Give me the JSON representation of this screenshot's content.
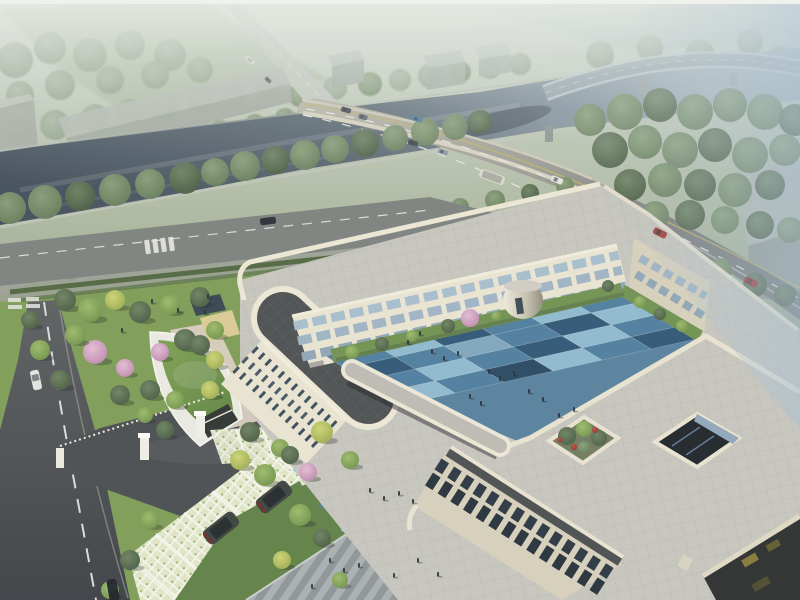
{
  "scene": {
    "type": "architectural aerial rendering",
    "description": "Hazy daytime bird's-eye view of a three-story cream-colored courtyard building complex beside a tree-lined river; a highway bridge crosses the river top-right, red cars and a bus travel the arterial road, a curved green-roof gatehouse and grass-grid parking with dark SUVs sit at the entrance, and a blue checkerboard courtyard plaza holds small groups of people."
  },
  "palette": {
    "haze_top": "#e6eae3",
    "mist_blue": "#aec1cf",
    "water": "#46525e",
    "water_far": "#9aa9b4",
    "bridge_deck": "#b7b3a4",
    "road_gray": "#74787a",
    "asphalt_dark": "#494c50",
    "local_road": "#7d817e",
    "site_lawn": "#7d9c55",
    "lawn_deep": "#5e8045",
    "facade_cream": "#e9e4d1",
    "facade_shade": "#d5cfba",
    "parapet": "#ece6d4",
    "roof_paver": "#c6c4bd",
    "roof_charcoal": "#4b4e50",
    "terrace_taupe": "#8b8074",
    "glass_band": "#a7bdcc",
    "glass_dark": "#2b3540",
    "court_base": "#57809c",
    "court_blue_light": "#8fb9cf",
    "court_blue_mid": "#4e7d9d",
    "court_blue_dark": "#2f5674",
    "court_blue_deep": "#27475f",
    "court_blue_pale": "#7fa6bd",
    "walk_blue": "#a3c2d2",
    "walk_slate": "#577e95",
    "grass_roof": "#6f9347",
    "blossom": "#d3a3c0",
    "lattice_paver": "#dfe5c4",
    "warehouse_gray": "#b2b8b1",
    "car_red": "#a23a2f",
    "suv_dark": "#3a413b",
    "plaza_stripe_light": "#a9aeb0",
    "plaza_stripe_dark": "#8e9496"
  },
  "courtyard": {
    "origin": [
      620,
      290
    ],
    "cs": [
      -49,
      11
    ],
    "rs": [
      20,
      12
    ],
    "colors": {
      "L": "#8fb9cf",
      "M": "#4e7d9d",
      "D": "#2f5674",
      "E": "#27475f",
      "G": "#7fa6bd"
    },
    "rows": [
      [
        "M",
        "L",
        "M",
        "D",
        "L",
        "M"
      ],
      [
        "L",
        "D",
        "M",
        "G",
        "M",
        "D"
      ],
      [
        "M",
        "L",
        "D",
        "M",
        "L",
        "M"
      ],
      [
        "D",
        "M",
        "L",
        "E",
        "M",
        "L"
      ]
    ]
  },
  "trees": {
    "back": [
      [
        20,
        130,
        13,
        "far"
      ],
      [
        55,
        125,
        15,
        "far"
      ],
      [
        95,
        118,
        14,
        "far"
      ],
      [
        130,
        112,
        13,
        "far"
      ],
      [
        165,
        108,
        14,
        "far"
      ],
      [
        200,
        100,
        13,
        "far"
      ],
      [
        235,
        95,
        12,
        "far"
      ],
      [
        270,
        90,
        13,
        "far"
      ],
      [
        300,
        95,
        12,
        "mid"
      ],
      [
        335,
        88,
        12,
        "far"
      ],
      [
        370,
        84,
        12,
        "mid"
      ],
      [
        400,
        80,
        11,
        "far"
      ],
      [
        430,
        76,
        12,
        "far"
      ],
      [
        460,
        72,
        11,
        "mid"
      ],
      [
        490,
        68,
        11,
        "far"
      ],
      [
        520,
        64,
        11,
        "far"
      ],
      [
        600,
        55,
        14,
        "far"
      ],
      [
        650,
        48,
        13,
        "far"
      ],
      [
        700,
        55,
        15,
        "far"
      ],
      [
        750,
        42,
        13,
        "far"
      ],
      [
        780,
        60,
        14,
        "far"
      ],
      [
        15,
        60,
        18,
        "far"
      ],
      [
        50,
        48,
        16,
        "far"
      ],
      [
        90,
        55,
        17,
        "far"
      ],
      [
        130,
        45,
        15,
        "far"
      ],
      [
        170,
        55,
        16,
        "far"
      ],
      [
        60,
        85,
        15,
        "far"
      ],
      [
        110,
        80,
        14,
        "far"
      ],
      [
        155,
        75,
        14,
        "far"
      ],
      [
        200,
        70,
        13,
        "far"
      ],
      [
        20,
        95,
        14,
        "far"
      ],
      [
        80,
        150,
        10,
        "mid"
      ],
      [
        115,
        145,
        11,
        "mid"
      ],
      [
        150,
        140,
        11,
        "mid"
      ],
      [
        185,
        135,
        10,
        "mid"
      ],
      [
        220,
        130,
        10,
        "mid"
      ],
      [
        255,
        124,
        10,
        "mid"
      ],
      [
        285,
        118,
        10,
        "mid"
      ]
    ],
    "mid": [
      [
        10,
        208,
        16,
        "mid"
      ],
      [
        45,
        202,
        17,
        "mid"
      ],
      [
        80,
        196,
        15,
        "dark"
      ],
      [
        115,
        190,
        16,
        "mid"
      ],
      [
        150,
        184,
        15,
        "mid"
      ],
      [
        185,
        178,
        16,
        "dark"
      ],
      [
        215,
        172,
        14,
        "mid"
      ],
      [
        245,
        166,
        15,
        "mid"
      ],
      [
        275,
        160,
        14,
        "dark"
      ],
      [
        305,
        155,
        15,
        "mid"
      ],
      [
        335,
        149,
        14,
        "mid"
      ],
      [
        365,
        143,
        14,
        "dark"
      ],
      [
        395,
        138,
        13,
        "mid"
      ],
      [
        425,
        132,
        14,
        "mid"
      ],
      [
        455,
        127,
        13,
        "mid"
      ],
      [
        480,
        122,
        12,
        "dark"
      ],
      [
        590,
        120,
        16,
        "mid"
      ],
      [
        625,
        112,
        18,
        "mid"
      ],
      [
        660,
        105,
        17,
        "dark"
      ],
      [
        695,
        112,
        18,
        "mid"
      ],
      [
        730,
        105,
        17,
        "mid"
      ],
      [
        765,
        112,
        18,
        "mid"
      ],
      [
        795,
        120,
        16,
        "dark"
      ],
      [
        610,
        150,
        18,
        "dark"
      ],
      [
        645,
        142,
        17,
        "mid"
      ],
      [
        680,
        150,
        18,
        "mid"
      ],
      [
        715,
        145,
        17,
        "dark"
      ],
      [
        750,
        155,
        18,
        "mid"
      ],
      [
        785,
        150,
        16,
        "mid"
      ],
      [
        630,
        185,
        16,
        "dark"
      ],
      [
        665,
        180,
        17,
        "mid"
      ],
      [
        700,
        185,
        16,
        "dark"
      ],
      [
        735,
        190,
        17,
        "mid"
      ],
      [
        770,
        185,
        15,
        "dark"
      ],
      [
        655,
        215,
        14,
        "mid"
      ],
      [
        690,
        215,
        15,
        "dark"
      ],
      [
        725,
        220,
        14,
        "mid"
      ],
      [
        760,
        225,
        14,
        "dark"
      ],
      [
        790,
        230,
        13,
        "mid"
      ],
      [
        690,
        260,
        12,
        "dark"
      ],
      [
        720,
        270,
        12,
        "mid"
      ],
      [
        755,
        285,
        12,
        "dark"
      ],
      [
        785,
        295,
        11,
        "dark"
      ],
      [
        250,
        252,
        10,
        "mid"
      ],
      [
        285,
        245,
        10,
        "dark"
      ],
      [
        320,
        237,
        10,
        "mid"
      ],
      [
        355,
        230,
        10,
        "dark"
      ],
      [
        390,
        222,
        9,
        "mid"
      ],
      [
        425,
        214,
        10,
        "dark"
      ],
      [
        460,
        207,
        9,
        "mid"
      ],
      [
        495,
        200,
        10,
        "mid"
      ],
      [
        530,
        193,
        9,
        "dark"
      ],
      [
        565,
        186,
        9,
        "mid"
      ],
      [
        30,
        280,
        9,
        "bright"
      ],
      [
        70,
        272,
        9,
        "dark"
      ],
      [
        110,
        264,
        9,
        "bright"
      ],
      [
        150,
        257,
        8,
        "dark"
      ],
      [
        190,
        250,
        9,
        "bright"
      ],
      [
        230,
        243,
        8,
        "dark"
      ],
      [
        270,
        236,
        8,
        "bright"
      ],
      [
        310,
        229,
        8,
        "dark"
      ],
      [
        350,
        222,
        8,
        "bright"
      ],
      [
        390,
        215,
        8,
        "dark"
      ],
      [
        430,
        208,
        8,
        "bright"
      ]
    ],
    "front": [
      [
        65,
        300,
        11,
        "dark",
        1
      ],
      [
        90,
        310,
        12,
        "bright",
        1
      ],
      [
        115,
        300,
        10,
        "yellow",
        1
      ],
      [
        140,
        312,
        11,
        "dark",
        1
      ],
      [
        170,
        305,
        10,
        "bright",
        1
      ],
      [
        200,
        297,
        10,
        "dark",
        1
      ],
      [
        95,
        352,
        12,
        "pink",
        1
      ],
      [
        125,
        368,
        9,
        "pink",
        1
      ],
      [
        160,
        352,
        9,
        "pink",
        1
      ],
      [
        75,
        335,
        10,
        "bright",
        1
      ],
      [
        185,
        340,
        11,
        "dark",
        1
      ],
      [
        215,
        330,
        9,
        "bright",
        1
      ],
      [
        200,
        345,
        10,
        "dark",
        1
      ],
      [
        215,
        360,
        9,
        "yellow",
        1
      ],
      [
        150,
        390,
        10,
        "dark",
        1
      ],
      [
        175,
        400,
        9,
        "bright",
        1
      ],
      [
        120,
        395,
        10,
        "dark",
        1
      ],
      [
        210,
        390,
        9,
        "yellow",
        1
      ],
      [
        60,
        380,
        10,
        "dark",
        1
      ],
      [
        40,
        350,
        10,
        "bright",
        1
      ],
      [
        30,
        320,
        9,
        "dark",
        1
      ],
      [
        165,
        430,
        9,
        "dark",
        1
      ],
      [
        145,
        415,
        8,
        "bright",
        1
      ],
      [
        250,
        432,
        10,
        "dark",
        1
      ],
      [
        280,
        448,
        9,
        "bright",
        1
      ],
      [
        308,
        472,
        9,
        "pink",
        1
      ],
      [
        240,
        460,
        10,
        "yellow",
        1
      ],
      [
        265,
        475,
        11,
        "bright",
        1
      ],
      [
        290,
        455,
        9,
        "dark",
        1
      ],
      [
        300,
        515,
        11,
        "bright",
        1
      ],
      [
        322,
        538,
        9,
        "dark",
        1
      ],
      [
        282,
        560,
        9,
        "yellow",
        1
      ],
      [
        150,
        520,
        9,
        "bright",
        1
      ],
      [
        130,
        560,
        10,
        "dark",
        1
      ],
      [
        110,
        590,
        9,
        "bright",
        1
      ],
      [
        340,
        580,
        8,
        "bright",
        1
      ],
      [
        322,
        432,
        11,
        "yellow",
        1
      ],
      [
        350,
        460,
        9,
        "bright",
        1
      ],
      [
        352,
        352,
        7,
        "bright"
      ],
      [
        382,
        344,
        7,
        "dark"
      ],
      [
        412,
        336,
        6,
        "bright"
      ],
      [
        448,
        326,
        7,
        "dark"
      ],
      [
        496,
        316,
        5,
        "bright"
      ],
      [
        470,
        318,
        9,
        "pink"
      ],
      [
        640,
        302,
        6,
        "bright"
      ],
      [
        660,
        314,
        6,
        "dark"
      ],
      [
        682,
        326,
        6,
        "bright"
      ],
      [
        608,
        286,
        6,
        "dark"
      ],
      [
        567,
        436,
        9,
        "dark"
      ],
      [
        584,
        429,
        8,
        "bright"
      ],
      [
        599,
        438,
        8,
        "dark"
      ],
      [
        584,
        447,
        6,
        "mid"
      ],
      [
        574,
        447,
        3,
        "red"
      ],
      [
        595,
        430,
        3,
        "red"
      ],
      [
        560,
        440,
        2.5,
        "red"
      ]
    ]
  },
  "people": [
    [
      432,
      349
    ],
    [
      444,
      356
    ],
    [
      458,
      351
    ],
    [
      489,
      369
    ],
    [
      500,
      376
    ],
    [
      514,
      371
    ],
    [
      470,
      394
    ],
    [
      481,
      401
    ],
    [
      529,
      389
    ],
    [
      543,
      397
    ],
    [
      559,
      413
    ],
    [
      574,
      407
    ],
    [
      420,
      331
    ],
    [
      408,
      340
    ],
    [
      330,
      558
    ],
    [
      344,
      568
    ],
    [
      359,
      563
    ],
    [
      394,
      573
    ],
    [
      312,
      584
    ],
    [
      418,
      558
    ],
    [
      438,
      572
    ],
    [
      370,
      488
    ],
    [
      384,
      496
    ],
    [
      399,
      491
    ],
    [
      413,
      499
    ],
    [
      152,
      299
    ],
    [
      178,
      308
    ],
    [
      208,
      294
    ],
    [
      122,
      328
    ],
    [
      205,
      310
    ]
  ],
  "vehicles": [
    {
      "x": 250,
      "y": 60,
      "a": 43,
      "w": 11,
      "h": 5,
      "c": "#d9d9d2",
      "t": "bus"
    },
    {
      "x": 268,
      "y": 80,
      "a": 43,
      "w": 7,
      "h": 4,
      "c": "#4c5258",
      "t": "car"
    },
    {
      "x": 346,
      "y": 110,
      "a": 15,
      "w": 10,
      "h": 5,
      "c": "#394047",
      "t": "car"
    },
    {
      "x": 363,
      "y": 117,
      "a": 15,
      "w": 9,
      "h": 5,
      "c": "#59616b",
      "t": "car"
    },
    {
      "x": 417,
      "y": 119,
      "a": 16,
      "w": 11,
      "h": 5,
      "c": "#49769f",
      "t": "car"
    },
    {
      "x": 413,
      "y": 143,
      "a": 16,
      "w": 10,
      "h": 5,
      "c": "#3e454c",
      "t": "car"
    },
    {
      "x": 443,
      "y": 152,
      "a": 18,
      "w": 10,
      "h": 5,
      "c": "#8d959e",
      "t": "car"
    },
    {
      "x": 492,
      "y": 177,
      "a": 20,
      "w": 26,
      "h": 9,
      "c": "#dbd8cb",
      "t": "bus"
    },
    {
      "x": 557,
      "y": 180,
      "a": 22,
      "w": 12,
      "h": 6,
      "c": "#e4e4de",
      "t": "car"
    },
    {
      "x": 660,
      "y": 233,
      "a": 27,
      "w": 14,
      "h": 7,
      "c": "#a23a2f",
      "t": "car"
    },
    {
      "x": 751,
      "y": 282,
      "a": 28,
      "w": 14,
      "h": 7,
      "c": "#992f2a",
      "t": "car"
    },
    {
      "x": 268,
      "y": 221,
      "a": -7,
      "w": 16,
      "h": 7,
      "c": "#2c3034",
      "t": "car"
    },
    {
      "x": 36,
      "y": 380,
      "a": 78,
      "w": 20,
      "h": 9,
      "c": "#e2e4e0",
      "t": "car"
    },
    {
      "x": 113,
      "y": 590,
      "a": 80,
      "w": 22,
      "h": 10,
      "c": "#1e2226",
      "t": "car"
    },
    {
      "x": 221,
      "y": 528,
      "a": 52,
      "w": 17,
      "h": 38,
      "c": "#3a413b",
      "t": "suv"
    },
    {
      "x": 274,
      "y": 497,
      "a": 52,
      "w": 17,
      "h": 38,
      "c": "#3a413b",
      "t": "suv"
    }
  ]
}
